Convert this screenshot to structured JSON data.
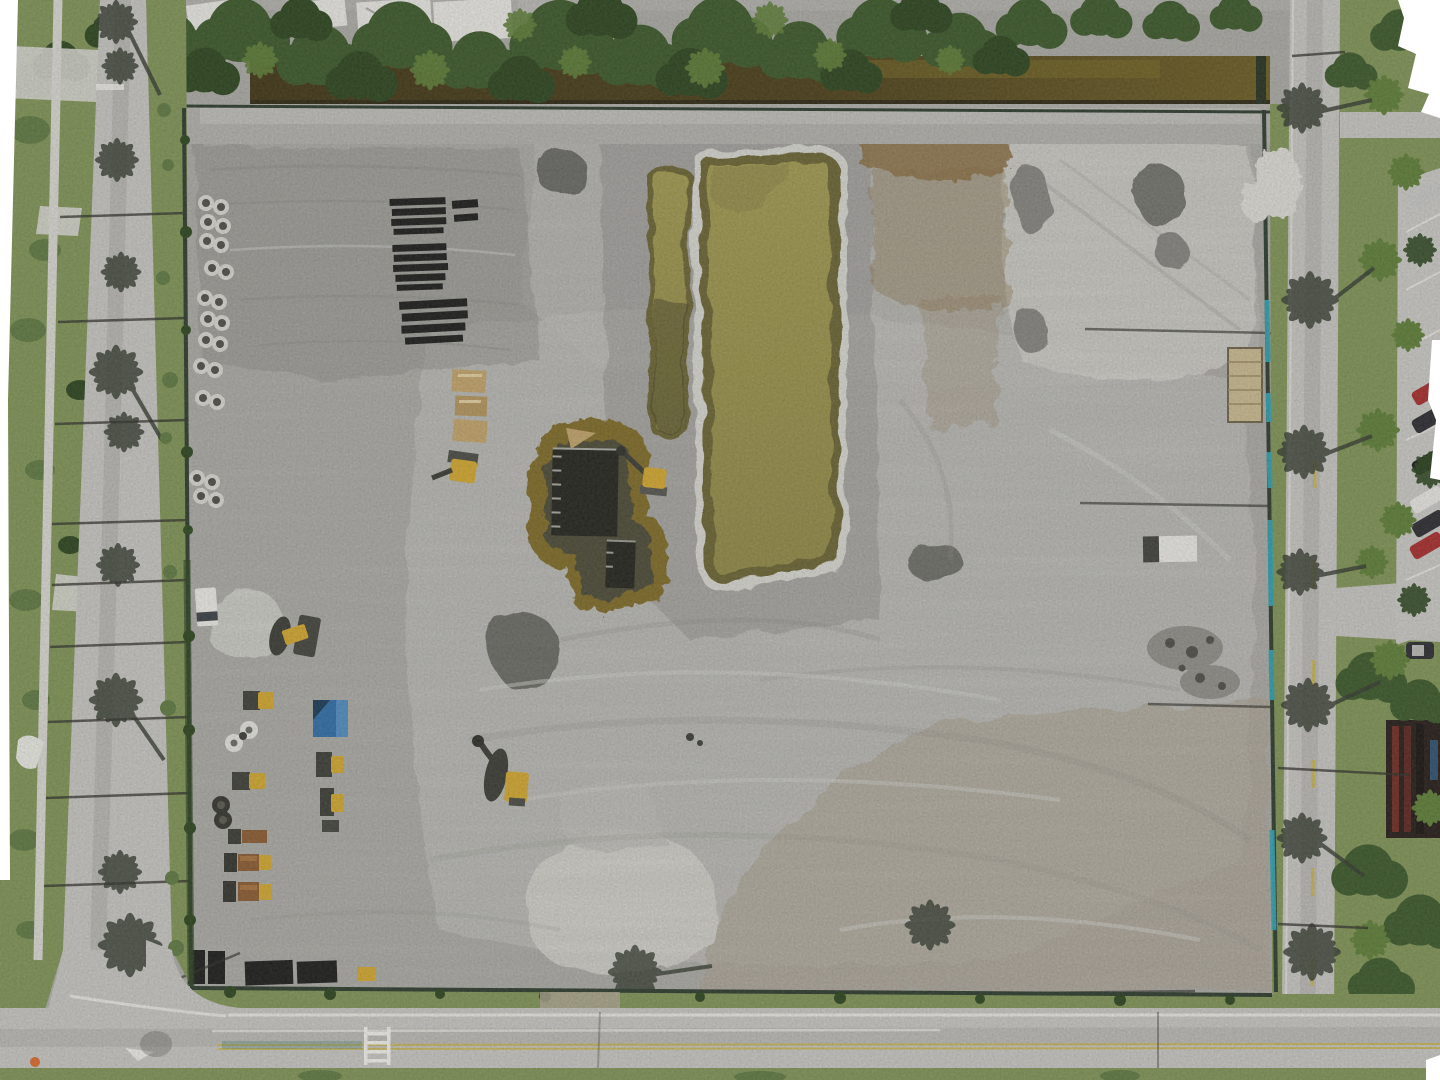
{
  "scene": {
    "title": "Aerial drone orthomosaic photo of a graded construction site bordered by roads, a drainage canal and tree lines",
    "labels": {
      "site_pad": "Cleared gray dirt construction pad",
      "west_road": "Road along west side with palm tree shadows",
      "south_road": "Road along south side with lane markings",
      "east_road": "Road along east side with palm tree shadows",
      "canal": "Drainage canal with brown water",
      "tree_line": "Dense tree line along north edge",
      "rooftops": "Building rooftops behind north tree line",
      "retention_pond": "Large retention pond with olive-green water",
      "channel_pond": "Narrow flooded excavation channel",
      "foundation_pond": "Flooded foundation excavation with formwork",
      "equipment_yard": "Construction equipment staging area",
      "concrete_pipes": "Stacked concrete pipe sections",
      "pipe_stacks": "Rows of staged dark pipe material",
      "pallets": "Stacked wooden pallets",
      "blue_container": "Blue storage container",
      "white_van": "White truck",
      "dump_trucks": "Dump trucks with rusty beds",
      "loader": "Yellow wheel loader",
      "excavator": "Yellow excavator",
      "pond_excavator": "Excavator working at flooded excavation",
      "sand_mound": "Light sand stockpile",
      "rust_patch": "Rust-stained soil patch",
      "white_trailer": "White site trailer",
      "mat_stack": "Tan mat stack",
      "rubble": "Rubble and debris piles",
      "silt_fence": "Perimeter silt fence",
      "silt_fence_blue": "Turquoise silt fence section",
      "parking": "Parking lot with parked cars",
      "building": "Dark building roof at southeast",
      "crosswalk": "Ladder crosswalk marking",
      "arrow_marking": "White pavement marking",
      "cone": "Orange marker",
      "palm_shadow": "Palm tree shadow",
      "palm": "Palm tree canopy",
      "pole_shadow": "Light pole shadow",
      "no_data": "White unmapped edge of orthomosaic",
      "sidewalk": "Sidewalk",
      "driveway": "Driveway apron",
      "grass": "Grass verge",
      "cars": "Parked cars",
      "spools": "Cable spools",
      "barrels": "Drums",
      "mats": "Dark crane mats"
    }
  },
  "palette": {
    "dirt_base": "#b1b0ab",
    "dirt_light": "#c7c6c1",
    "dirt_lighter": "#dcdbd5",
    "dirt_dark": "#8f8e88",
    "dirt_darker": "#72716b",
    "dirt_wet": "#4e4d47",
    "dirt_tan": "#b2a795",
    "rust": "#8a6a35",
    "pond": "#a19950",
    "pond_deep": "#8f8844",
    "pond_edge": "#6a6433",
    "canal": "#4a3e18",
    "canal_light": "#6b5c22",
    "bank": "#7e6a28",
    "lpond": "#4c4936",
    "pit": "#23231c",
    "grass": "#7f9355",
    "grass_dark": "#5e7840",
    "tree": "#3a5728",
    "tree_dark": "#2b441d",
    "leaf": "#5d7d36",
    "shadow": "#333a2e",
    "road": "#c6c5c1",
    "road_dark": "#a8a7a2",
    "white_line": "#eceae4",
    "yellow_line": "#c9b44a",
    "fence": "#2c3a2c",
    "cyan": "#2fa3b5",
    "blue": "#2e6da6",
    "blue_light": "#4f8cc0",
    "blue_dark": "#1a3a57",
    "yellow": "#d2a72e",
    "brown": "#8a5a30",
    "nodata": "#ffffff",
    "red": "#a62b2b",
    "car_dark": "#2b2b30",
    "silver": "#c6c6c3",
    "black": "#1b1b1a",
    "wood": "#c2a36a",
    "concrete": "#d8d7d1",
    "white_paint": "#f2f1ec"
  }
}
